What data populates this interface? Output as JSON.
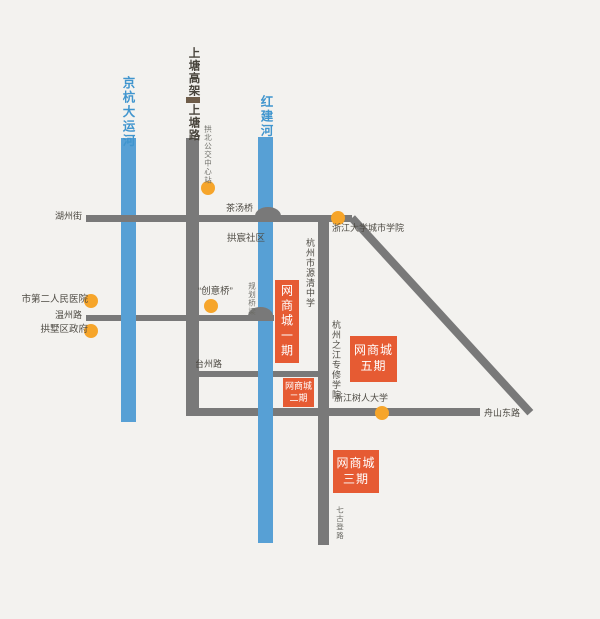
{
  "map": {
    "colors": {
      "background": "#f3f2ef",
      "road": "#797979",
      "river": "#57a0d5",
      "river_label": "#4095ce",
      "marker": "#f6a52a",
      "site_box": "#e65b33",
      "viaduct_dash": "#6e5c49"
    },
    "rivers": {
      "grand_canal": "京杭大运河",
      "hongjian": "红建河"
    },
    "roads": {
      "shangtang_viaduct": "上塘高架",
      "shangtang": "上塘路",
      "huzhou": "湖州街",
      "wenzhou": "温州路",
      "taizhou": "台州路",
      "zhoushan_east": "舟山东路",
      "qigudeng": "七古登路"
    },
    "bridges": {
      "chatang": "茶汤桥",
      "creative": "“创意桥”",
      "planned": "规划桥梁"
    },
    "pois": {
      "gongbei_bus_center": "拱北公交中心站",
      "gongchen_community": "拱宸社区",
      "zju_city_college": "浙江大学城市学院",
      "yuanqing_school": "杭州市源清中学",
      "second_hospital": "市第二人民医院",
      "gongshu_government": "拱墅区政府",
      "zhijiang_college": "杭州之江专修学院",
      "shuren_university": "浙江树人大学"
    },
    "sites": {
      "phase1": "网商城一期",
      "phase2_line1": "网商城",
      "phase2_line2": "二期",
      "phase3_line1": "网商城",
      "phase3_line2": "三期",
      "phase5_line1": "网商城",
      "phase5_line2": "五期"
    }
  }
}
